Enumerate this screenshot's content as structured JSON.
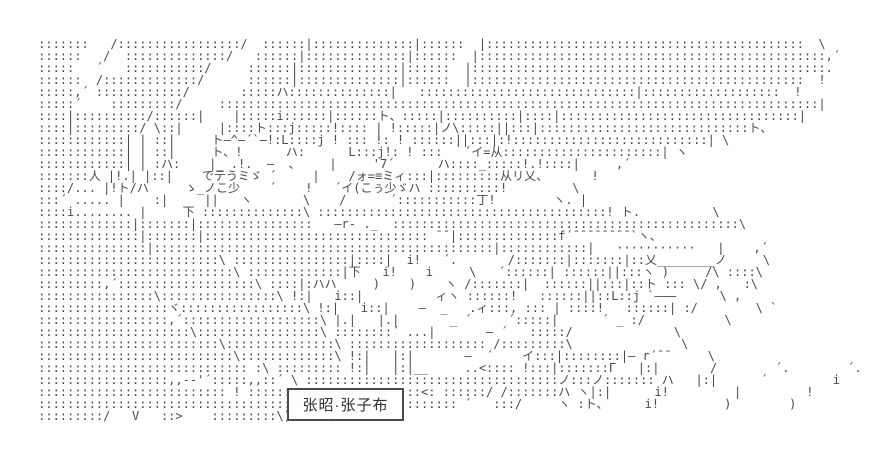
{
  "page": {
    "background_color": "#ffffff",
    "ink_color": "#4a4a4a",
    "kind": "ascii-art-scene"
  },
  "nameplate": {
    "label": "张昭·张子布",
    "border_color": "#4b4b4b"
  },
  "speech_bubble": {
    "text": "···········"
  },
  "art": {
    "lines": [
      "     :::::::   /:::::::::::::::::/  ::::::|::::::::::::::|::::::  |::::::::::::::::::::::::::::::::::::::::::::  \\",
      "     ::::::   /  ::::::::::::::/   ::::::|::::::::::::::|::::::  |::::::::::::::::::::::::::::::::::::::::::::::::,´",
      "     :::::   ´   :::::::::::/     ::::::|::::::::::::::|::::::  |:::::::::::::::::::::::::::::::::::::::::::::::::.",
      "     ::::::  /:::::::::::::/      ::::::|::::::::::::::|::::::  |::::::::::::::::::::::::::::::::::::::::::::::  !",
      "     :::::,´ ::::::::::::/       :::::ハ::::::::::::::|   ::::::::::::::::::::::::::::::|:::::::::::::::::::  !",
      "     :::::´    :::::::::/     :::::::::::::::::::::::::::::::::::::::::::::::::::::::::::::::::::::::::::::::::::|",
      "     ::::|::::::::::/::::::|    |:::::i::::::|::::::ト、:::::|::::::::::|::::|:::::::::::::::::::::::::::::::::|",
      "     ::::|:::::::::/ \\::|     |::::ト:::j:::::!:::: | !:::::|ノ\\:::::||:::|:::::::::::::::::::::::::::::ト、",
      "     ::::::::::::| | ::|     ト―^―´`―!:L::::j ! ::: !: ! ::::::||:::|:!:::::::::::::::::::::::::::| \\",
      "     ::::::::::::| | ::|     ト、!      ハ:      L:::j!: ! :::   ´イ=从::::::::::::::::::::::| ヽ",
      "     ::::::::::::| | :ハ:    |_ .!.  ―  、    |     '7´      ハ::::_:::::!.!::::|     ,´",
      "     :::::::人 |!.| |::|    でテうミゞ ´     |    /ォ=≡ミィ:::|:::::::::从リ乂、      !",
      "     ::::/... |!ト/ハ     ゝ_ノこ少    ´    !   ´イ(こぅ少ゞハ ::::::::::!         \\",
      "     :::´ ..... |    :|     ||   ヽ       \\    /      ´:::::::::::丁!        ヽ. |",
      "     ::::i........ |     下 ::::::::::::::\\ ::::::::::::::::::::::::::::::::::::::::! ト.          \\",
      "     :::::::::::::|:::::::|::::::::::::::::   ―r‐ ._  ::::::::::::::::::::::::::::::::::::::::::::::::\\",
      "     ::::::::::::::|:::::::|::::::::::::::::::::::::::::::: ¯¯|::::::::::::::f´¯¯¯¯¯¯¯¯`ヽ、",
      "     :::::::::::::::|:::::::::::::::::::::::::::::::::::::::::::::::|::::::::::::|   ···········   |    ,´",
      "     :::::::::::::::::::::::::\\ ::::::::::::::::|::::|  i!   ´.       /:::::::|:::::::|::乂________ノ     \\",
      "     :::::::::::::::::::::::::::\\ :::::::::::::|下   i!    i     \\   ´::::::| ::::::||:::ヽ )     /\\ ::::\\",
      "     :::::::::,´:::::::::::::::::::\\ ::::|:ハハ     )    )    ヽ /:::::::|  ::::::||:::|::ト ::: \\/ ,   :\\",
      "     ::::::::::::::::\\::::::::::::::::\\ !:|   i::|          ィヽ ::::::!   ::::::||::L::j `―――      \\ ,",
      "     ::::::::::::::::::ヾ:::::::::::::::::\\ !:|   i::|    ―  _   .ィ:::, ::: | ::::!   ::::::| :/        \\ `",
      "     ::::::::::::::::::,´:::::::::::::::::::\\ |.|   |.|       _ ´     ´:::::|      ´ _ :/           \\",
      "     :::::::::::::::::::::\\:::::::::::::::::\\ ::::::::´ ...|       ― ´   :::::/              \\",
      "     :::::::::::::::::::::::::\\:::::::::::::::\\ ::::::::::::::::::: /:::::::::\\               \\",
      "     :::::::::::::::::::::::::::\\:::::::::::::\\ !:|   |:|       ―  ´    イ:::|::::::::|― r´¯¯     \\",
      "     ::::::::::::::::::::::::::::: :\\ ::::::::: !:|   |:|__     ..<:::: !:::|:::::::Γ   |:|       /        ´.        ´.",
      "     ::::::::::::::::::,,-‐'´:::::,,::´ \\ :::::::::::::::::::::::::::::::::::ノ:::ノ::::::: ハ   |:|      ´         i         i",
      "     :::::::::::::::::::::::::: ! ::::::::::::::::::::::::<: ::::::/ /:::::::ハ ヽ|:|      i!         |         !",
      "     :::::::::::::::::::::::::::::::::::::::::::::::::::::::::: ´   :::/     ヽ :ト、     i!         )        )",
      "     :::::::::/   V   ::>    :::::::::\\)> :::\\::::::::",
      "",
      ""
    ]
  }
}
